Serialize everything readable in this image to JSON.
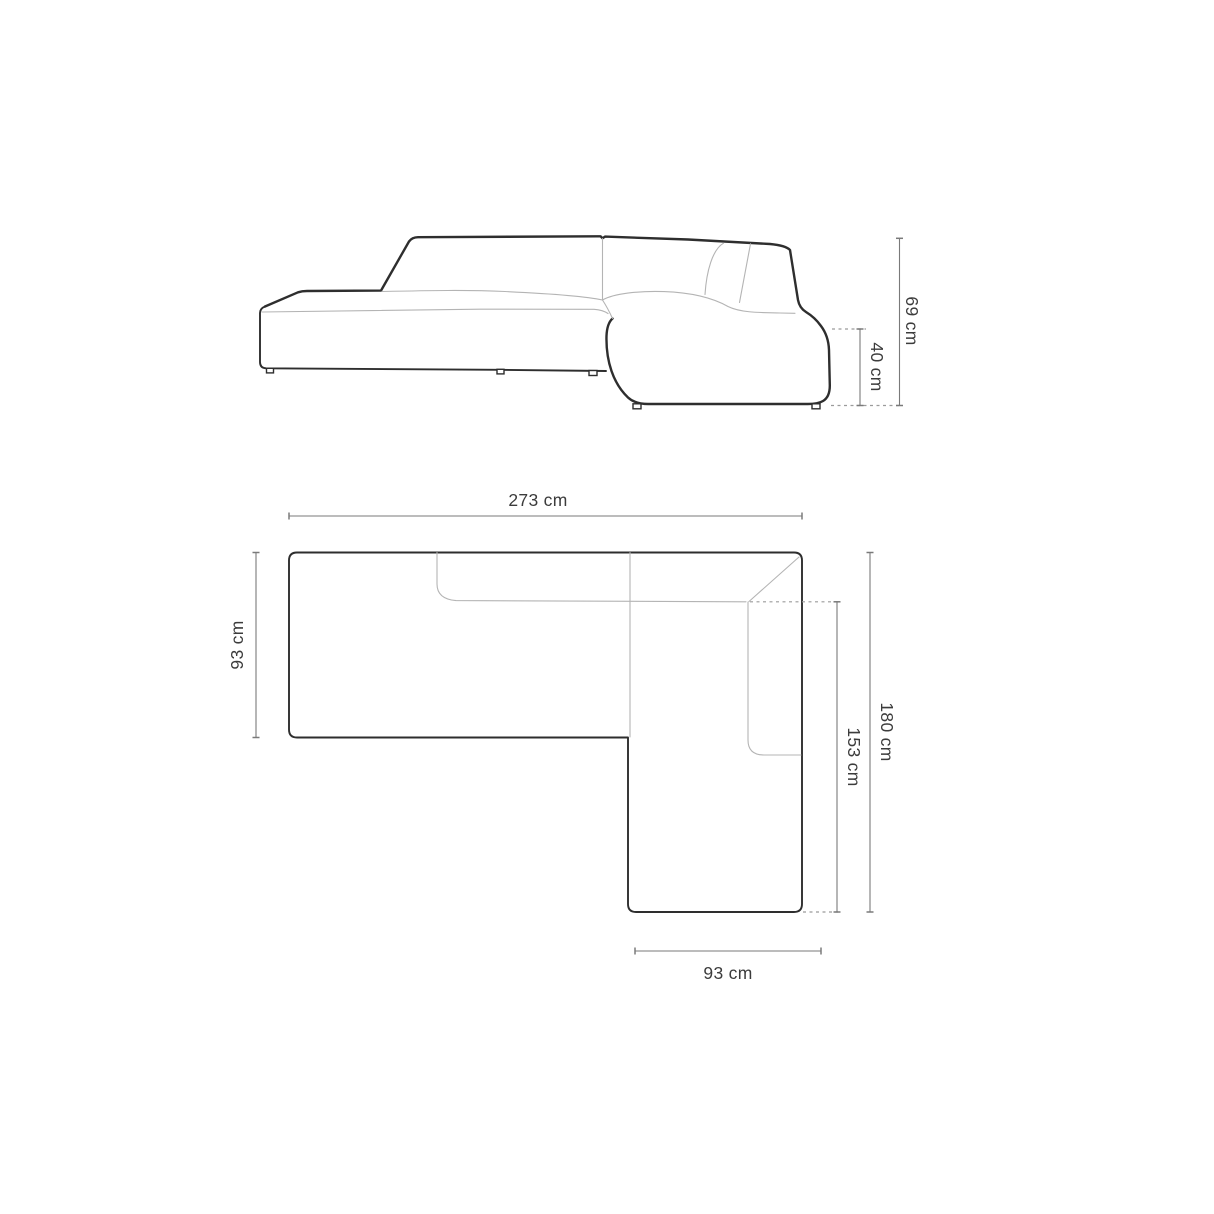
{
  "diagram": {
    "front_view": {
      "total_height_label": "69 cm",
      "seat_height_label": "40 cm"
    },
    "top_view": {
      "total_width_label": "273 cm",
      "left_depth_label": "93 cm",
      "total_depth_label": "180 cm",
      "chaise_length_label": "153 cm",
      "chaise_width_label": "93 cm"
    },
    "colors": {
      "background": "#ffffff",
      "outline": "#2e2e2e",
      "seam": "#b4b4b4",
      "dimension_line": "#7a7a7a",
      "dashed_reference": "#9b9b9b",
      "label_text": "#3c3c3c"
    }
  }
}
